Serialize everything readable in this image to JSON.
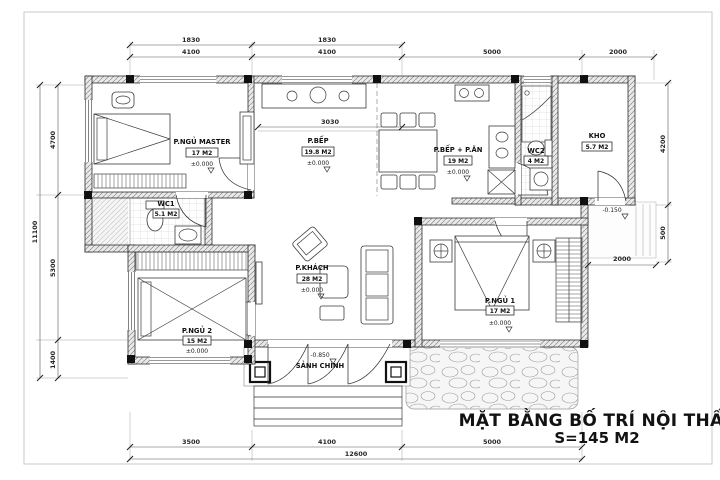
{
  "title": {
    "line1": "MẶT BẰNG BỐ TRÍ NỘI THẤT",
    "line2": "S=145 M2"
  },
  "rooms": {
    "master": {
      "name": "P.NGỦ MASTER",
      "area": "17 M2",
      "elev": "±0.000"
    },
    "kitchen": {
      "name": "P.BẾP",
      "area": "19.8 M2",
      "elev": "±0.000"
    },
    "dining": {
      "name": "P.BẾP + P.ĂN",
      "area": "19 M2",
      "elev": "±0.000"
    },
    "wc2": {
      "name": "WC2",
      "area": "4 M2"
    },
    "kho": {
      "name": "KHO",
      "area": "5.7 M2"
    },
    "wc1": {
      "name": "WC1",
      "area": "5.1 M2"
    },
    "living": {
      "name": "P.KHÁCH",
      "area": "28 M2",
      "elev": "±0.000"
    },
    "bed2": {
      "name": "P.NGỦ 2",
      "area": "15 M2",
      "elev": "±0.000"
    },
    "bed1": {
      "name": "P.NGỦ 1",
      "area": "17 M2",
      "elev": "±0.000"
    },
    "porch": {
      "name": "SẢNH CHÍNH",
      "elev": "-0.850"
    }
  },
  "levels": {
    "path": "-0.150"
  },
  "dims": {
    "top_upper": [
      "1830",
      "1830"
    ],
    "top_lower": [
      "4100",
      "4100",
      "5000",
      "2000"
    ],
    "bottom": [
      "3500",
      "4100",
      "5000"
    ],
    "bottom_total": "12600",
    "left": [
      "4700",
      "5300",
      "1400"
    ],
    "left_total": "11100",
    "right": [
      "4200",
      "500"
    ],
    "right_inner": "2000",
    "kitchen_width": "3030"
  }
}
